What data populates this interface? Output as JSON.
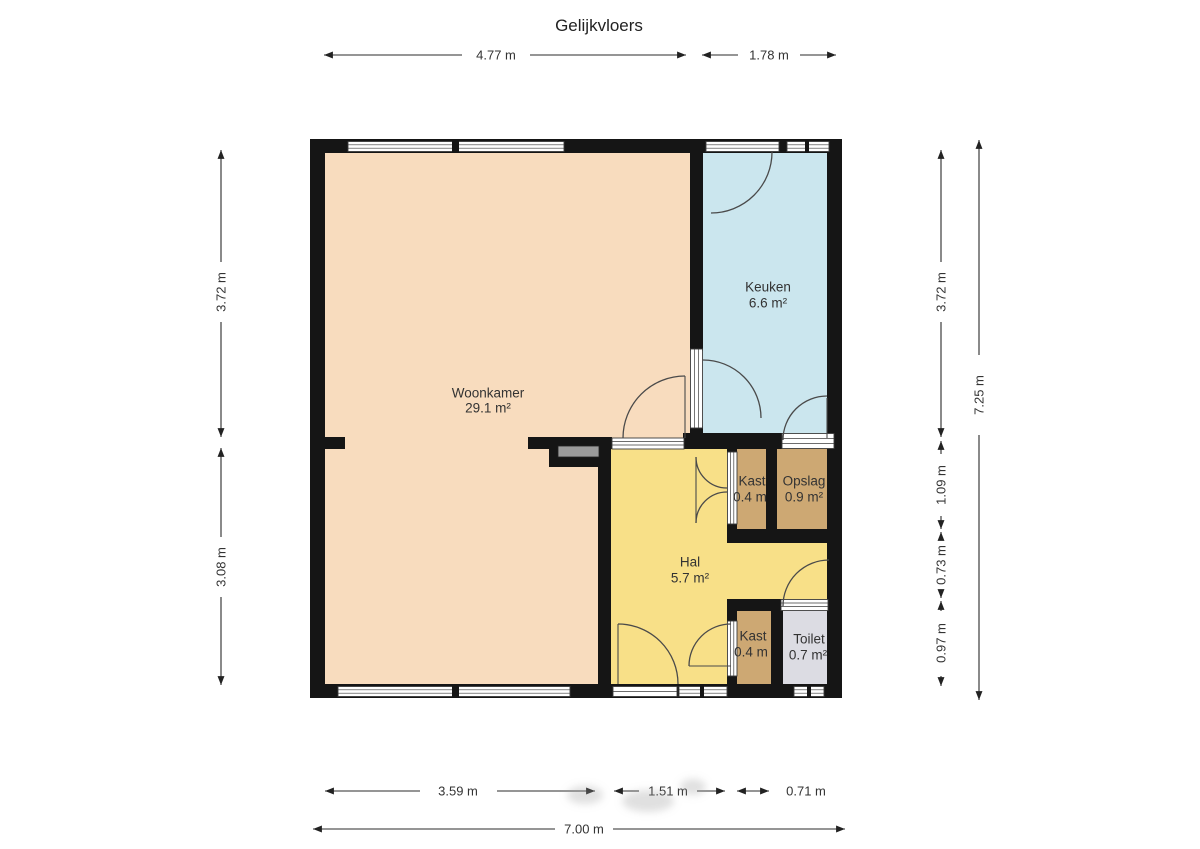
{
  "title": "Gelijkvloers",
  "colors": {
    "wall": "#151515",
    "woonkamer": "#F8DCBE",
    "keuken": "#CBE6EE",
    "hal": "#F8E088",
    "kast": "#CDA873",
    "opslag": "#CDA873",
    "toilet": "#DCDCE3"
  },
  "rooms": {
    "woonkamer": {
      "name": "Woonkamer",
      "area": "29.1 m²"
    },
    "keuken": {
      "name": "Keuken",
      "area": "6.6 m²"
    },
    "hal": {
      "name": "Hal",
      "area": "5.7 m²"
    },
    "kast_boven": {
      "name": "Kast",
      "area": "0.4 m"
    },
    "opslag": {
      "name": "Opslag",
      "area": "0.9 m²"
    },
    "kast_onder": {
      "name": "Kast",
      "area": "0.4 m"
    },
    "toilet": {
      "name": "Toilet",
      "area": "0.7 m²"
    }
  },
  "dims": {
    "top": [
      "4.77 m",
      "1.78 m"
    ],
    "bottom": [
      "3.59 m",
      "1.51 m",
      "0.71 m"
    ],
    "bottom_total": "7.00 m",
    "left": [
      "3.72 m",
      "3.08 m"
    ],
    "right": [
      "3.72 m",
      "1.09 m",
      "0.73 m",
      "0.97 m"
    ],
    "right_total": "7.25 m"
  }
}
